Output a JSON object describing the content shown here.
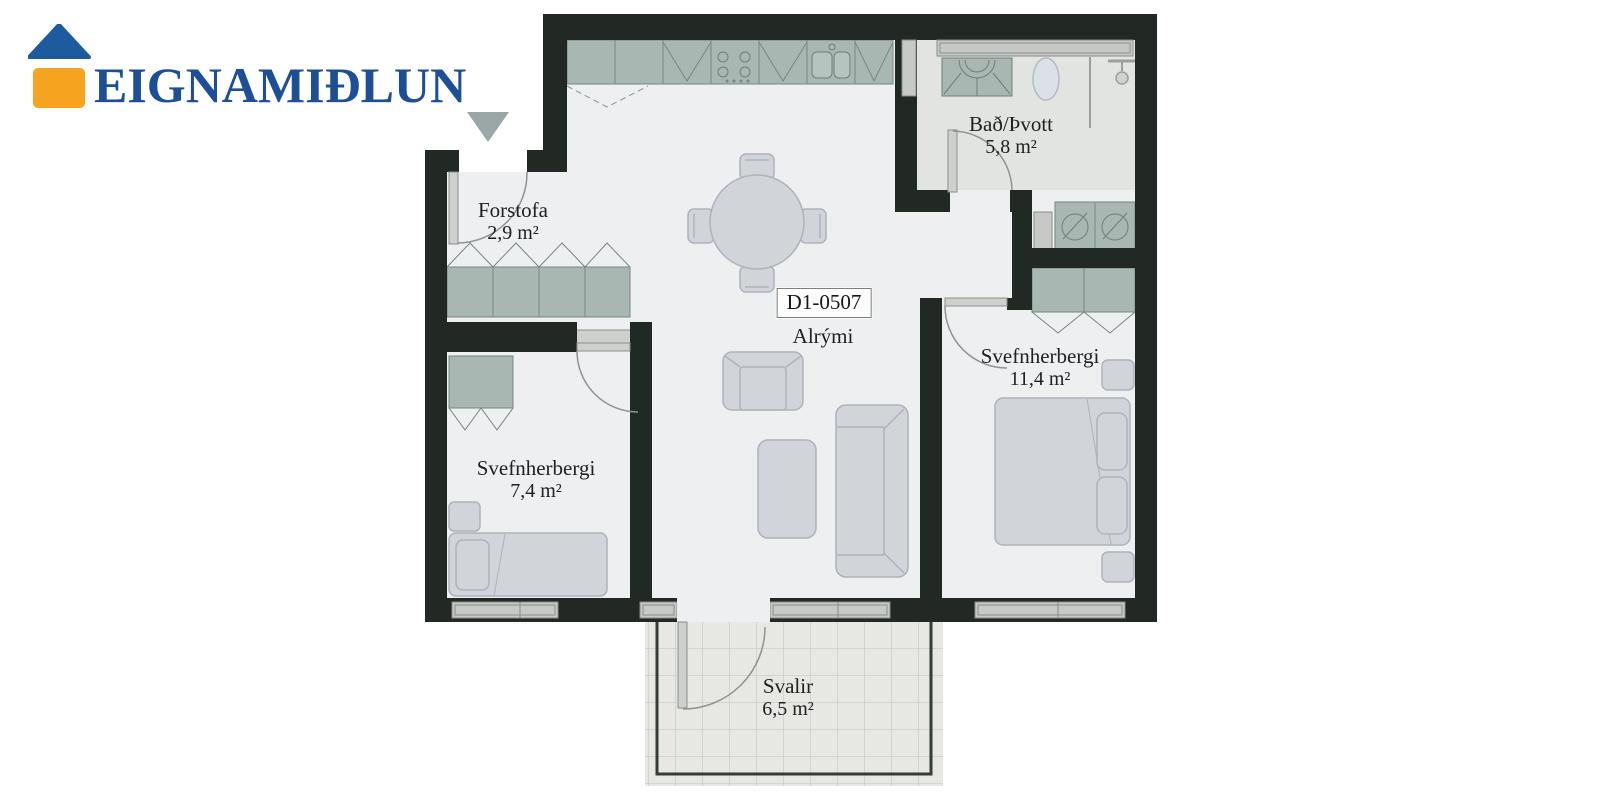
{
  "brand": {
    "name": "EIGNAMIÐLUN",
    "logo_colors": {
      "roof_blue": "#1d5b9e",
      "body_orange": "#f6a31f",
      "text_blue": "#1d4f96"
    }
  },
  "unit": {
    "id_label": "D1-0507"
  },
  "rooms": {
    "forstofa": {
      "label": "Forstofa",
      "area": "2,9 m²"
    },
    "bath": {
      "label": "Bað/Þvott",
      "area": "5,8 m²"
    },
    "alrymi": {
      "label": "Alrými",
      "area": ""
    },
    "bedroom_large": {
      "label": "Svefnherbergi",
      "area": "11,4 m²"
    },
    "bedroom_small": {
      "label": "Svefnherbergi",
      "area": "7,4 m²"
    },
    "balcony": {
      "label": "Svalir",
      "area": "6,5 m²"
    }
  },
  "icons": {
    "entrance_marker": "entrance-arrow-down",
    "logo_house": "house-icon"
  },
  "palette": {
    "wall": "#222823",
    "floor": "#edeff1",
    "bath_floor": "#e2e4e1",
    "cabinet_sage": "#a8b7b2",
    "furniture_gray": "#d1d5da",
    "window_gray": "#c7c9c6",
    "balcony_tile": "#e7e8e4",
    "arrow_gray": "#9ba6a7",
    "door_arc": "#8f948f"
  }
}
